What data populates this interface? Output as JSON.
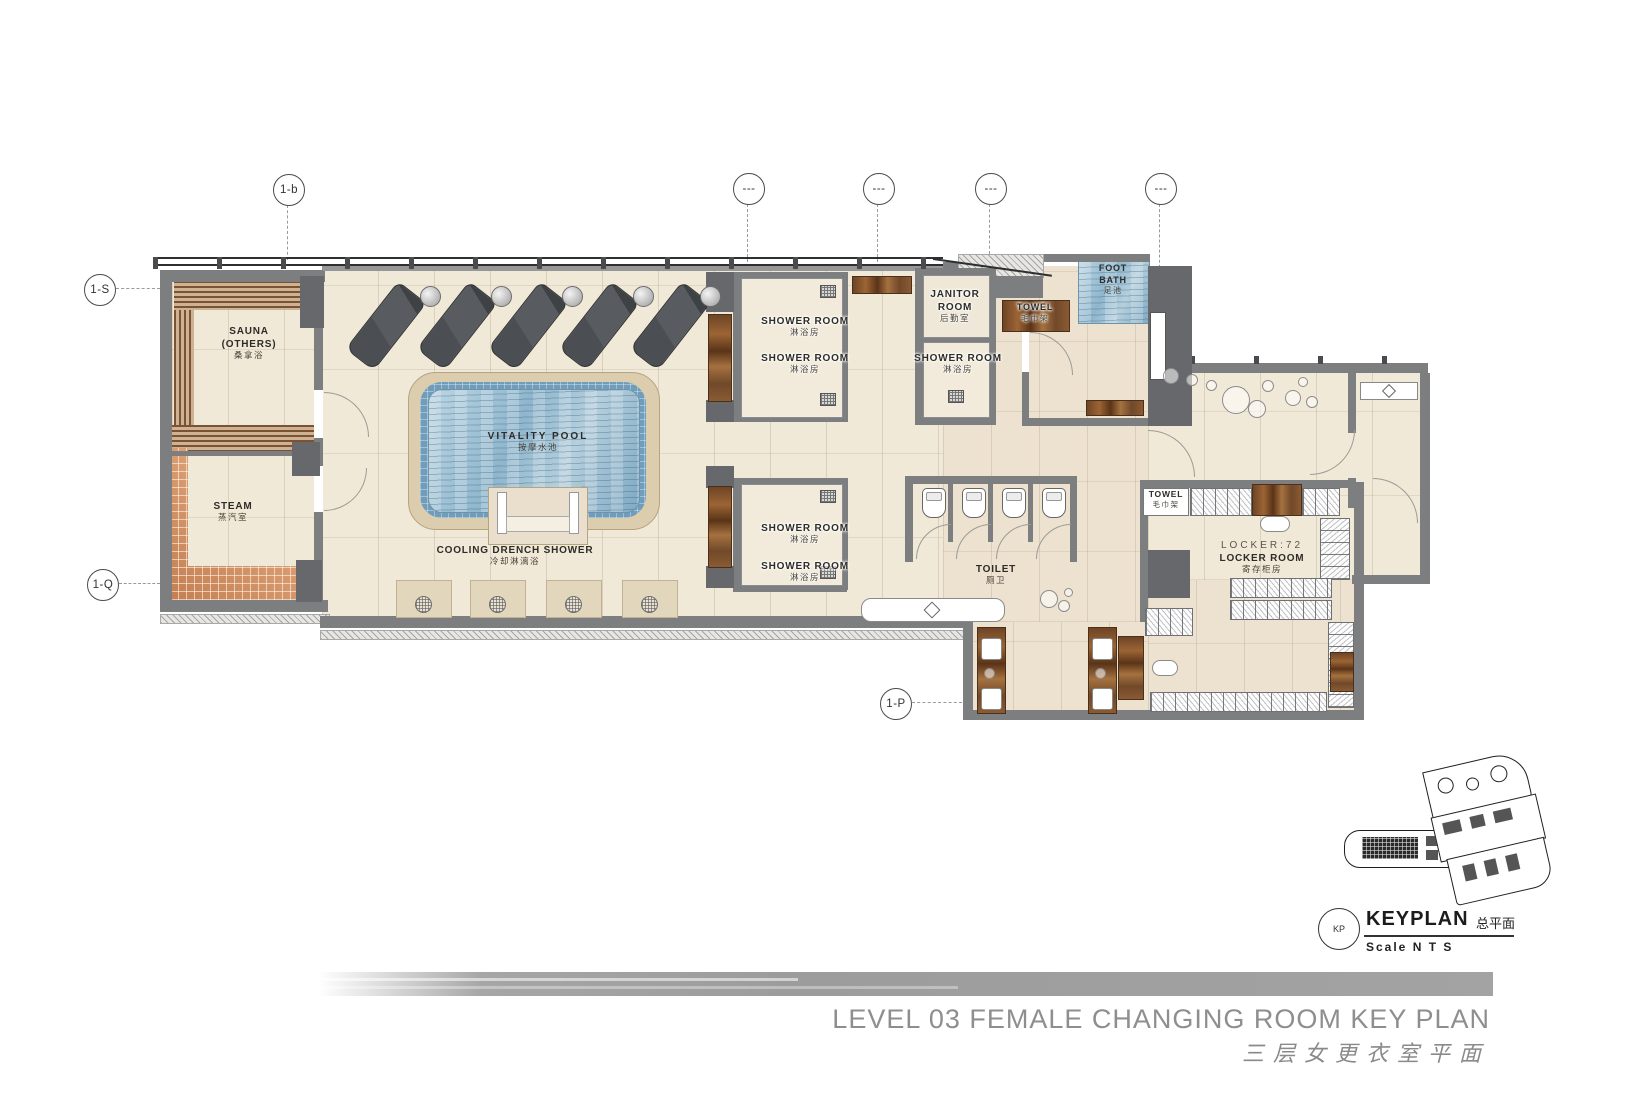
{
  "colors": {
    "wall": "#7d7e80",
    "floor": "#f1e9d8",
    "water": "#9fc2d8",
    "wood": "#8a5a33",
    "mosaic": "#cf8d60",
    "title_gray": "#8e8e8e"
  },
  "grid": {
    "b": "1-b",
    "s": "1-S",
    "q": "1-Q",
    "p": "1-P",
    "dash": "---"
  },
  "rooms": {
    "sauna": {
      "line1": "SAUNA",
      "line2": "(OTHERS)",
      "cn": "桑拿浴"
    },
    "steam": {
      "en": "STEAM",
      "cn": "蒸汽室"
    },
    "pool": {
      "en": "VITALITY POOL",
      "cn": "按摩水池"
    },
    "cooling": {
      "en": "COOLING DRENCH SHOWER",
      "cn": "冷却淋漓浴"
    },
    "shower": {
      "en": "SHOWER ROOM",
      "cn": "淋浴房"
    },
    "janitor": {
      "line1": "JANITOR",
      "line2": "ROOM",
      "cn": "后勤室"
    },
    "towel": {
      "en": "TOWEL",
      "cn": "毛巾架"
    },
    "footbath": {
      "line1": "FOOT",
      "line2": "BATH",
      "cn": "足池"
    },
    "toilet": {
      "en": "TOILET",
      "cn": "厕卫"
    },
    "locker": {
      "count": "LOCKER:72",
      "en": "LOCKER ROOM",
      "cn": "寄存柜房"
    }
  },
  "keyplan": {
    "badge": "KP",
    "title": "KEYPLAN",
    "title_cn": "总平面",
    "scale": "Scale  N T S"
  },
  "titleblock": {
    "en": "LEVEL 03 FEMALE CHANGING ROOM KEY PLAN",
    "cn": "三层女更衣室平面"
  }
}
